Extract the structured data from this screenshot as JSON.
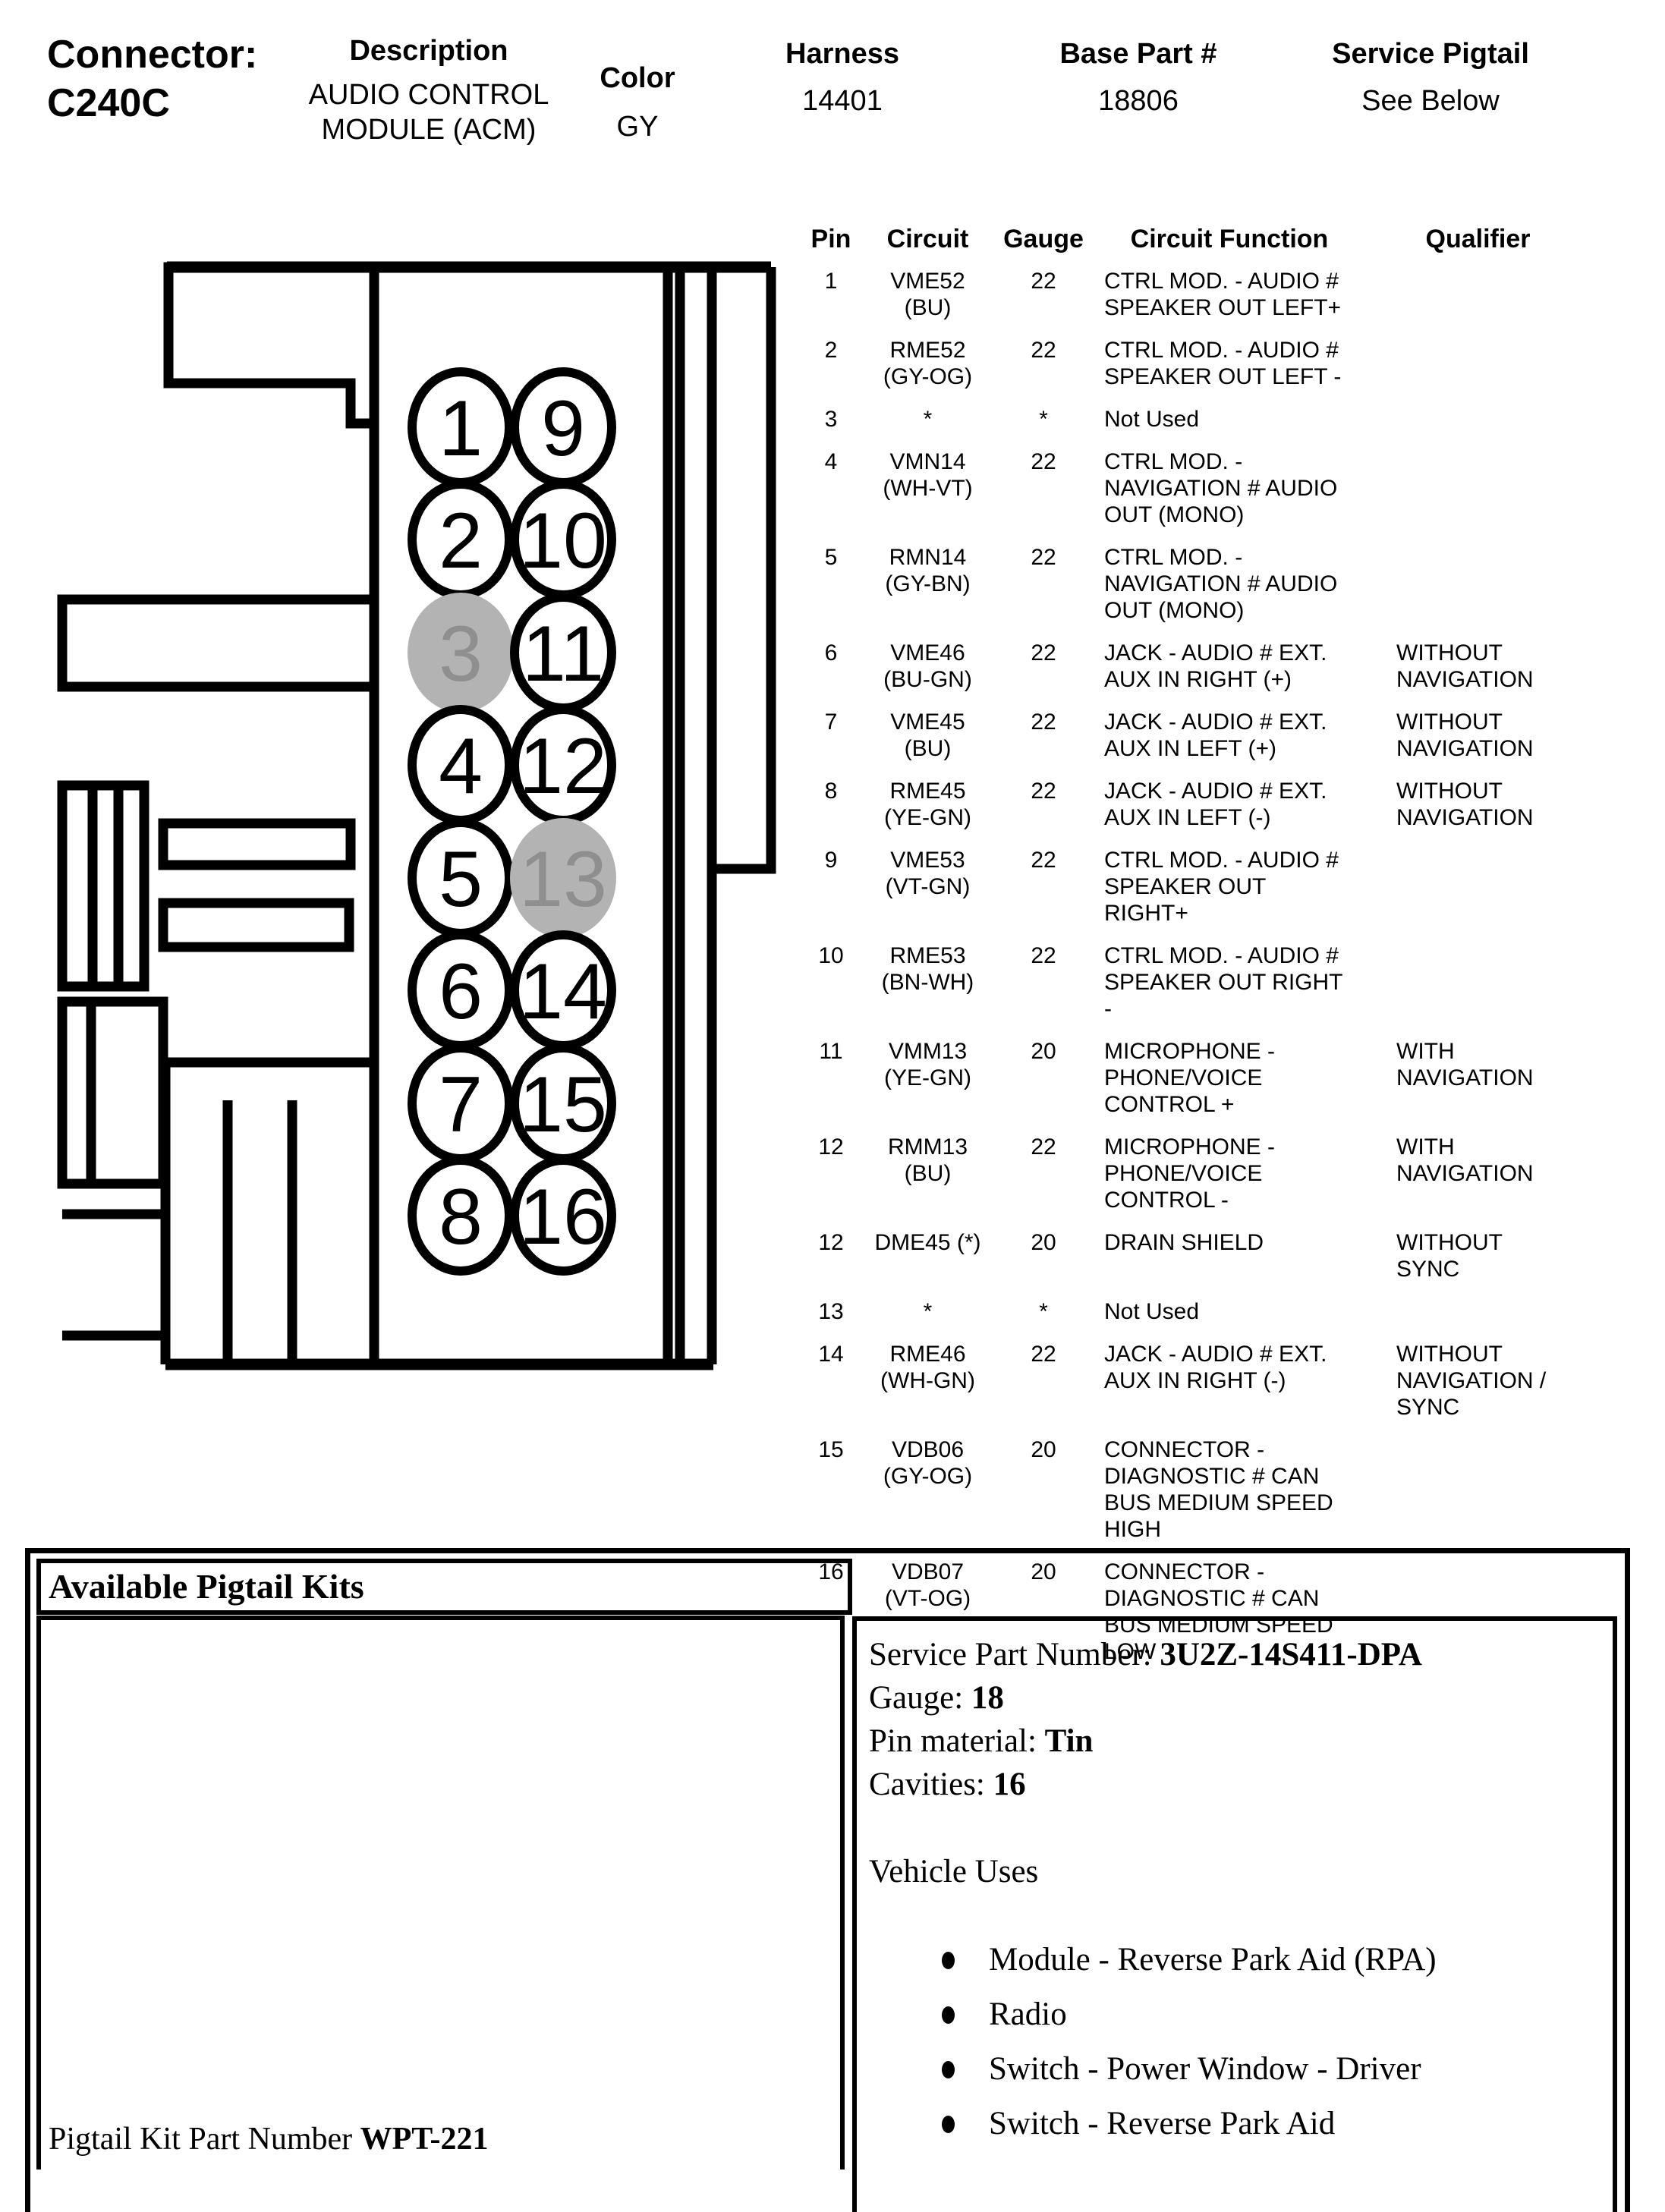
{
  "header": {
    "connector_label": "Connector:",
    "connector_id": "C240C",
    "fields": [
      {
        "label": "Description",
        "value": "AUDIO CONTROL MODULE (ACM)"
      },
      {
        "label": "Color",
        "value": "GY"
      },
      {
        "label": "Harness",
        "value": "14401"
      },
      {
        "label": "Base Part #",
        "value": "18806"
      },
      {
        "label": "Service Pigtail",
        "value": "See Below"
      }
    ]
  },
  "pin_table": {
    "headers": [
      "Pin",
      "Circuit",
      "Gauge",
      "Circuit Function",
      "Qualifier"
    ],
    "rows": [
      {
        "pin": "1",
        "circuit": "VME52",
        "color": "(BU)",
        "gauge": "22",
        "function": "CTRL MOD. - AUDIO # SPEAKER OUT LEFT+",
        "qualifier": ""
      },
      {
        "pin": "2",
        "circuit": "RME52",
        "color": "(GY-OG)",
        "gauge": "22",
        "function": "CTRL MOD. - AUDIO # SPEAKER OUT LEFT -",
        "qualifier": ""
      },
      {
        "pin": "3",
        "circuit": "*",
        "color": "",
        "gauge": "*",
        "function": "Not Used",
        "qualifier": ""
      },
      {
        "pin": "4",
        "circuit": "VMN14",
        "color": "(WH-VT)",
        "gauge": "22",
        "function": "CTRL MOD. - NAVIGATION # AUDIO OUT (MONO)",
        "qualifier": ""
      },
      {
        "pin": "5",
        "circuit": "RMN14",
        "color": "(GY-BN)",
        "gauge": "22",
        "function": "CTRL MOD. - NAVIGATION # AUDIO OUT (MONO)",
        "qualifier": ""
      },
      {
        "pin": "6",
        "circuit": "VME46",
        "color": "(BU-GN)",
        "gauge": "22",
        "function": "JACK - AUDIO # EXT. AUX IN RIGHT (+)",
        "qualifier": "WITHOUT NAVIGATION"
      },
      {
        "pin": "7",
        "circuit": "VME45",
        "color": "(BU)",
        "gauge": "22",
        "function": "JACK - AUDIO # EXT. AUX IN LEFT (+)",
        "qualifier": "WITHOUT NAVIGATION"
      },
      {
        "pin": "8",
        "circuit": "RME45",
        "color": "(YE-GN)",
        "gauge": "22",
        "function": "JACK - AUDIO # EXT. AUX IN LEFT (-)",
        "qualifier": "WITHOUT NAVIGATION"
      },
      {
        "pin": "9",
        "circuit": "VME53",
        "color": "(VT-GN)",
        "gauge": "22",
        "function": "CTRL MOD. - AUDIO # SPEAKER OUT RIGHT+",
        "qualifier": ""
      },
      {
        "pin": "10",
        "circuit": "RME53",
        "color": "(BN-WH)",
        "gauge": "22",
        "function": "CTRL MOD. - AUDIO # SPEAKER OUT RIGHT -",
        "qualifier": ""
      },
      {
        "pin": "11",
        "circuit": "VMM13",
        "color": "(YE-GN)",
        "gauge": "20",
        "function": "MICROPHONE - PHONE/VOICE CONTROL +",
        "qualifier": "WITH NAVIGATION"
      },
      {
        "pin": "12",
        "circuit": "RMM13",
        "color": "(BU)",
        "gauge": "22",
        "function": "MICROPHONE - PHONE/VOICE CONTROL -",
        "qualifier": "WITH NAVIGATION"
      },
      {
        "pin": "12",
        "circuit": "DME45 (*)",
        "color": "",
        "gauge": "20",
        "function": "DRAIN SHIELD",
        "qualifier": "WITHOUT SYNC"
      },
      {
        "pin": "13",
        "circuit": "*",
        "color": "",
        "gauge": "*",
        "function": "Not Used",
        "qualifier": ""
      },
      {
        "pin": "14",
        "circuit": "RME46",
        "color": "(WH-GN)",
        "gauge": "22",
        "function": "JACK - AUDIO # EXT. AUX IN RIGHT (-)",
        "qualifier": "WITHOUT NAVIGATION / SYNC"
      },
      {
        "pin": "15",
        "circuit": "VDB06",
        "color": "(GY-OG)",
        "gauge": "20",
        "function": "CONNECTOR - DIAGNOSTIC # CAN BUS MEDIUM SPEED HIGH",
        "qualifier": ""
      },
      {
        "pin": "16",
        "circuit": "VDB07",
        "color": "(VT-OG)",
        "gauge": "20",
        "function": "CONNECTOR - DIAGNOSTIC # CAN BUS MEDIUM SPEED LOW",
        "qualifier": ""
      }
    ]
  },
  "connector_diagram": {
    "left_pins": [
      "1",
      "2",
      "3",
      "4",
      "5",
      "6",
      "7",
      "8"
    ],
    "right_pins": [
      "9",
      "10",
      "11",
      "12",
      "13",
      "14",
      "15",
      "16"
    ],
    "not_used_pins": [
      "3",
      "13"
    ],
    "outline_color": "#000000",
    "circle_fill": "#ffffff",
    "not_used_fill": "#b3b3b3",
    "not_used_text_color": "#8f8f8f"
  },
  "pigtail": {
    "box_title": "Available Pigtail Kits",
    "kit_part_number_label": "Pigtail Kit Part Number",
    "kit_part_number": "WPT-221",
    "details": [
      {
        "label": "Service Part Number: ",
        "value": "3U2Z-14S411-DPA"
      },
      {
        "label": "Gauge: ",
        "value": "18"
      },
      {
        "label": "Pin material: ",
        "value": "Tin"
      },
      {
        "label": "Cavities: ",
        "value": "16"
      }
    ],
    "vehicle_uses_title": "Vehicle Uses",
    "vehicle_uses": [
      "Module - Reverse Park Aid (RPA)",
      "Radio",
      "Switch - Power Window - Driver",
      "Switch - Reverse Park Aid"
    ]
  }
}
